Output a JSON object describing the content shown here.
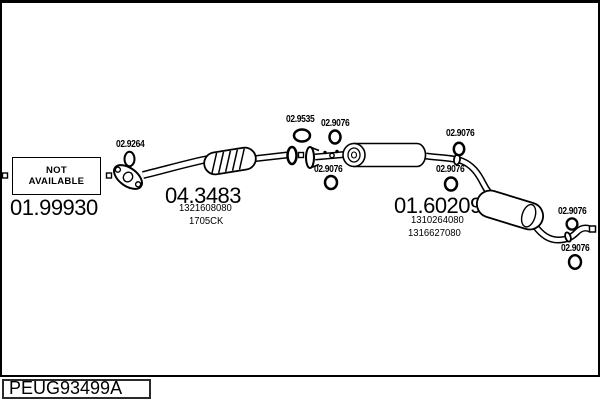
{
  "footer": {
    "catalog_code": "PEUG93499A"
  },
  "parts": {
    "front_pipe": {
      "ref": "01.99930",
      "availability_line1": "NOT",
      "availability_line2": "AVAILABLE"
    },
    "catalytic_converter": {
      "ref": "04.3483",
      "oem_number": "1321608080",
      "engine_code": "1705CK"
    },
    "rear_silencer": {
      "ref": "01.60209",
      "oem_number_1": "1310264080",
      "oem_number_2": "1316627080"
    }
  },
  "fitting_labels": [
    {
      "id": "gasket-02-9264",
      "text": "02.9264"
    },
    {
      "id": "gasket-02-9535",
      "text": "02.9535"
    },
    {
      "id": "clamp-02-9076-joint-top",
      "text": "02.9076"
    },
    {
      "id": "clamp-02-9076-joint-bottom",
      "text": "02.9076"
    },
    {
      "id": "clamp-02-9076-mid-top",
      "text": "02.9076"
    },
    {
      "id": "clamp-02-9076-mid-bottom",
      "text": "02.9076"
    },
    {
      "id": "clamp-02-9076-tail-top",
      "text": "02.9076"
    },
    {
      "id": "clamp-02-9076-tail-bottom",
      "text": "02.9076"
    }
  ]
}
